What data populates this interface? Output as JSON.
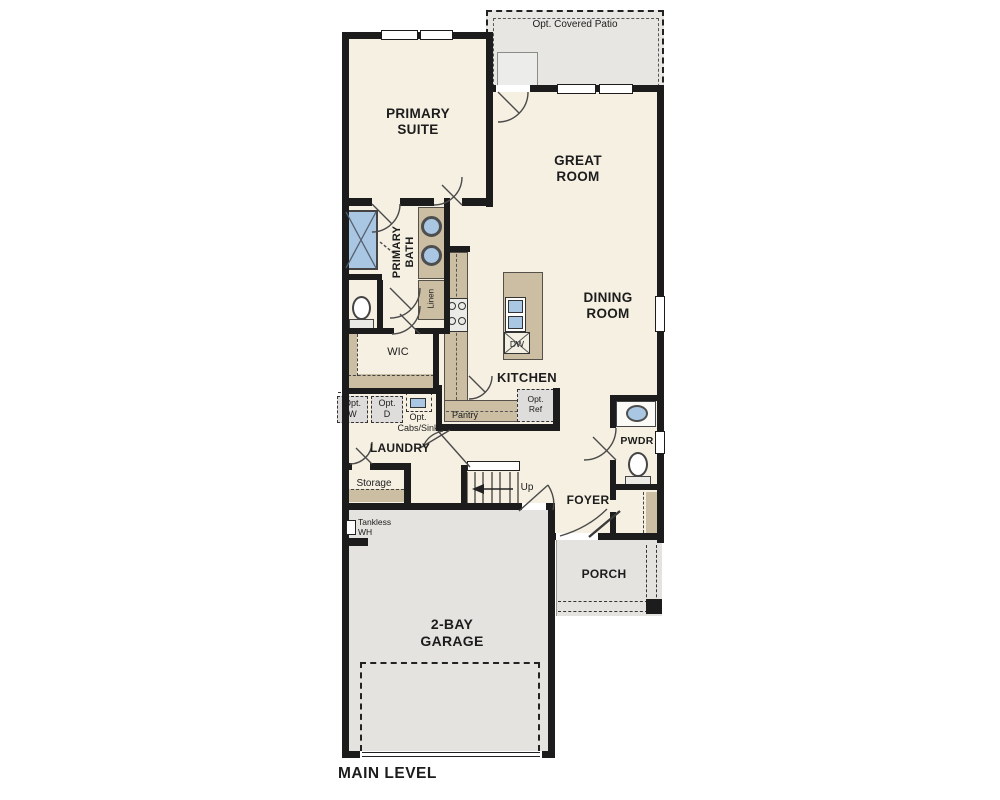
{
  "plan": {
    "title": "MAIN LEVEL",
    "rooms": {
      "patio": "Opt. Covered Patio",
      "primary_suite": "PRIMARY\nSUITE",
      "great_room": "GREAT\nROOM",
      "primary_bath": "PRIMARY\nBATH",
      "linen": "Linen",
      "wic": "WIC",
      "kitchen": "KITCHEN",
      "pantry": "Pantry",
      "dining_room": "DINING\nROOM",
      "laundry": "LAUNDRY",
      "storage": "Storage",
      "foyer": "FOYER",
      "pwdr": "PWDR",
      "porch": "PORCH",
      "garage": "2-BAY\nGARAGE"
    },
    "annotations": {
      "opt_washer": "Opt.\nW",
      "opt_dryer": "Opt.\nD",
      "opt_cabs_sink": "Opt.\nCabs/Sink",
      "opt_ref": "Opt.\nRef",
      "tankless_wh": "Tankless\nWH",
      "up": "Up",
      "dishwasher": "DW"
    },
    "colors": {
      "floor": "#f6f0e2",
      "exterior_concrete": "#e4e3e0",
      "cabinetry": "#cbbea3",
      "plumbing_fixture": "#a9c6e2",
      "wall": "#1c1c1c"
    }
  }
}
